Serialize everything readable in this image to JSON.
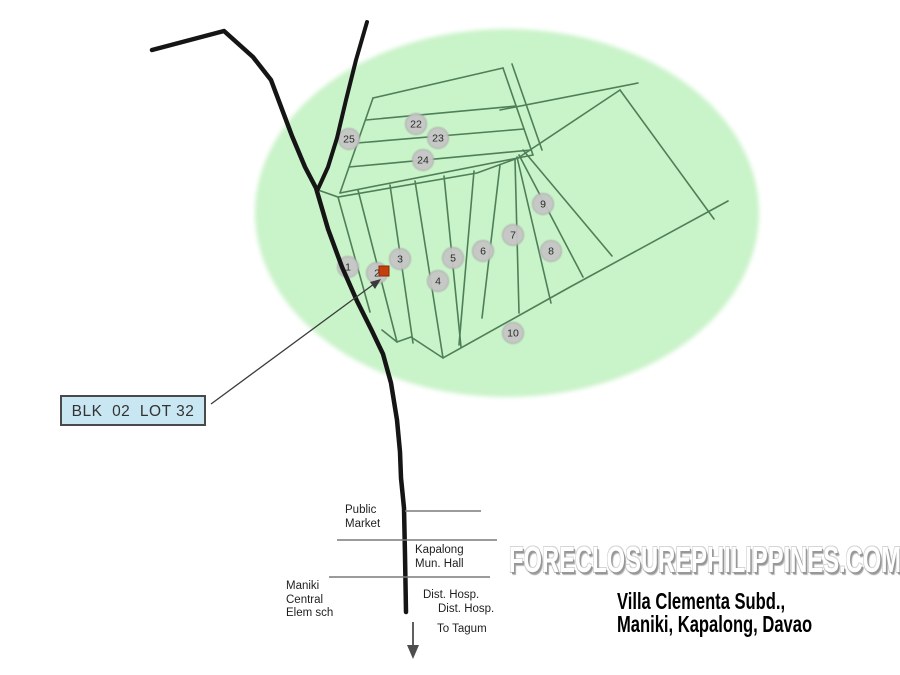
{
  "map": {
    "colors": {
      "ellipse": "#c9f3c9",
      "street": "#4f7f58",
      "road": "#151515",
      "marker_fill": "#c6c6c6",
      "marker_border": "#a8a8a8",
      "flag_red": "#c2410c",
      "flag_red_edge": "#8a2c08",
      "label_bg": "#c9e7f2",
      "label_border": "#4a4a4a",
      "pointer": "#3b3b3b",
      "landmark_line": "#7a7a7a",
      "arrow": "#4d4d4d"
    },
    "lot_label": "BLK  02  LOT 32",
    "markers": [
      {
        "n": "25",
        "x": 349,
        "y": 139
      },
      {
        "n": "22",
        "x": 416,
        "y": 124
      },
      {
        "n": "23",
        "x": 438,
        "y": 138
      },
      {
        "n": "24",
        "x": 423,
        "y": 160
      },
      {
        "n": "1",
        "x": 348,
        "y": 267
      },
      {
        "n": "2",
        "x": 377,
        "y": 273
      },
      {
        "n": "3",
        "x": 400,
        "y": 259
      },
      {
        "n": "4",
        "x": 438,
        "y": 281
      },
      {
        "n": "5",
        "x": 453,
        "y": 258
      },
      {
        "n": "6",
        "x": 483,
        "y": 251
      },
      {
        "n": "7",
        "x": 513,
        "y": 235
      },
      {
        "n": "8",
        "x": 551,
        "y": 251
      },
      {
        "n": "9",
        "x": 543,
        "y": 204
      },
      {
        "n": "10",
        "x": 513,
        "y": 333
      }
    ],
    "landmarks": {
      "public_market": [
        "Public",
        "Market"
      ],
      "mun_hall": [
        "Kapalong",
        "Mun. Hall"
      ],
      "school": [
        "Maniki",
        "Central",
        "Elem sch"
      ],
      "hospital_1": "Dist. Hosp.",
      "hospital_2": "Dist. Hosp.",
      "to_tagum": "To Tagum"
    },
    "watermark": "FORECLOSUREPHILIPPINES.COM",
    "title": [
      "Villa Clementa Subd.,",
      "Maniki, Kapalong, Davao"
    ]
  }
}
